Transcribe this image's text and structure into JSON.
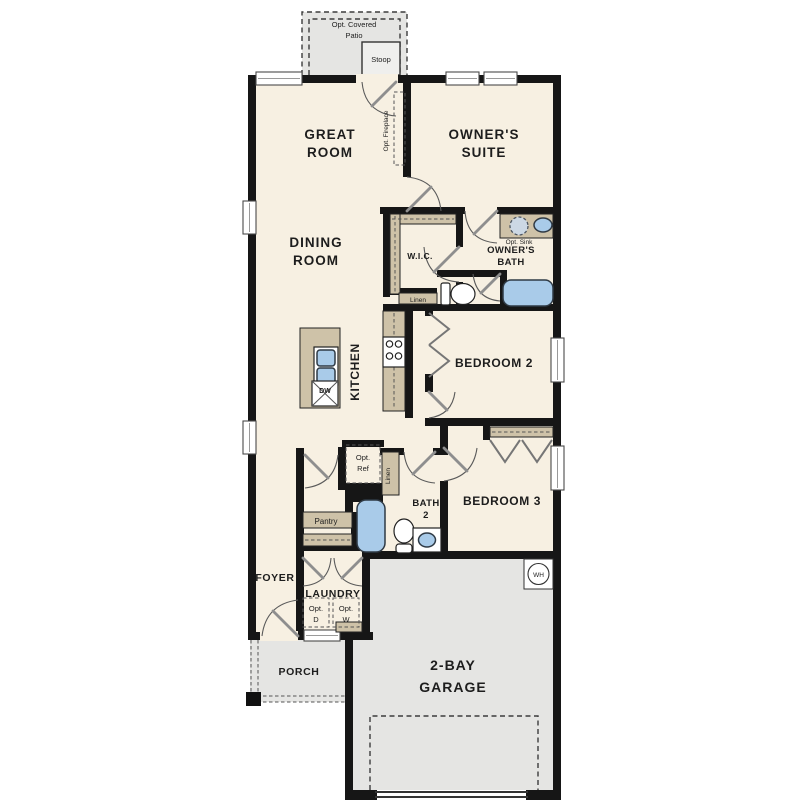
{
  "plan": {
    "title": "single-story floor plan",
    "rooms": {
      "great_room": {
        "line1": "GREAT",
        "line2": "ROOM"
      },
      "owners_suite": {
        "line1": "OWNER'S",
        "line2": "SUITE"
      },
      "dining_room": {
        "line1": "DINING",
        "line2": "ROOM"
      },
      "owners_bath": {
        "line1": "OWNER'S",
        "line2": "BATH"
      },
      "wic": "W.I.C.",
      "kitchen": "KITCHEN",
      "bedroom2": "BEDROOM 2",
      "bedroom3": "BEDROOM 3",
      "bath2": {
        "line1": "BATH",
        "line2": "2"
      },
      "foyer": "FOYER",
      "laundry": "LAUNDRY",
      "pantry": "Pantry",
      "porch": "PORCH",
      "garage": {
        "line1": "2-BAY",
        "line2": "GARAGE"
      }
    },
    "annotations": {
      "opt_covered_patio": {
        "line1": "Opt. Covered",
        "line2": "Patio"
      },
      "stoop": "Stoop",
      "opt_fireplace": "Opt. Fireplace",
      "opt_sink": "Opt. Sink",
      "linen_owners": "Linen",
      "linen_bath2": "Linen",
      "opt_ref": {
        "line1": "Opt.",
        "line2": "Ref"
      },
      "opt_dryer": {
        "line1": "Opt.",
        "line2": "D"
      },
      "opt_washer": {
        "line1": "Opt.",
        "line2": "W"
      },
      "dishwasher": "DW",
      "water_heater": "WH"
    },
    "colors": {
      "wall": "#161616",
      "floor_interior": "#f7f0e2",
      "concrete": "#e5e5e3",
      "cabinet_tan": "#cec2a8",
      "fixture_blue": "#a9cbe9",
      "dash_gray": "#3c3c3c"
    }
  }
}
